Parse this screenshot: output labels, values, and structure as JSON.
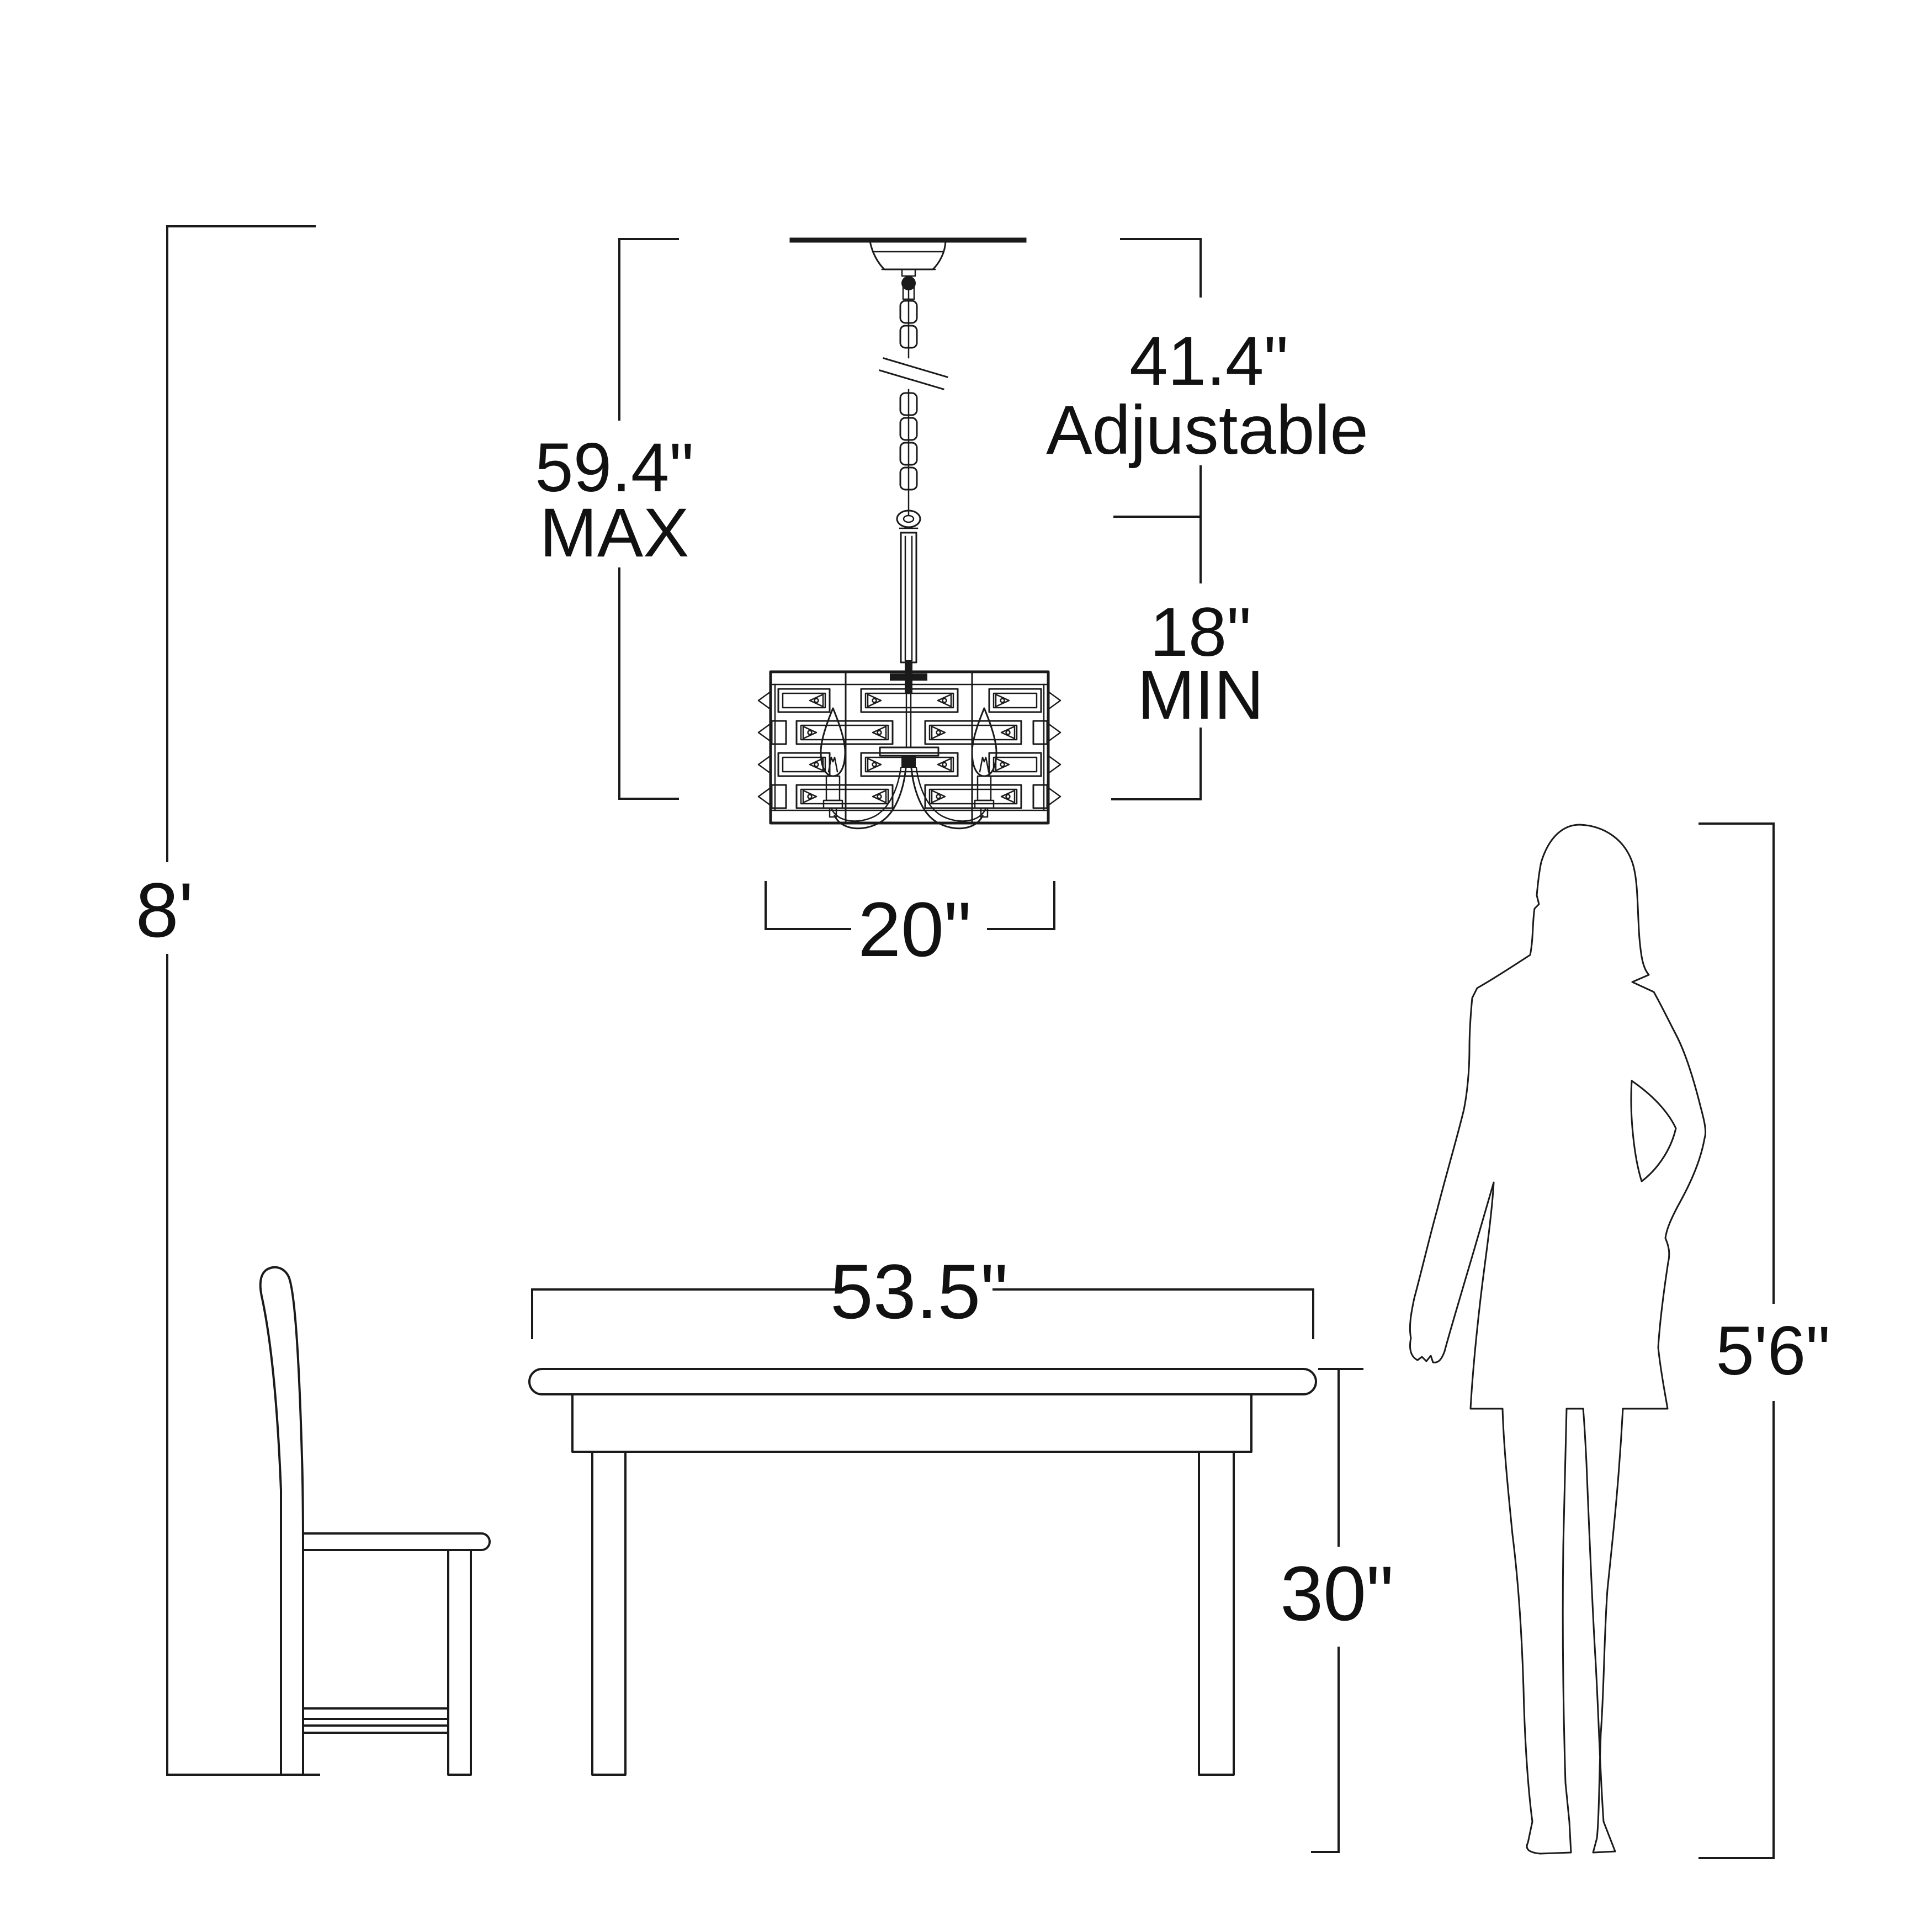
{
  "diagram": {
    "background": "#ffffff",
    "line_color": "#1a1a1a",
    "dimensions": {
      "ceiling_height": "8'",
      "fixture_overall_max": "59.4\"",
      "fixture_overall_max_qualifier": "MAX",
      "suspension_adjustable": "41.4\"",
      "suspension_adjustable_qualifier": "Adjustable",
      "suspension_min": "18\"",
      "suspension_min_qualifier": "MIN",
      "fixture_width": "20\"",
      "table_width": "53.5\"",
      "table_height": "30\"",
      "person_height": "5'6\""
    }
  }
}
